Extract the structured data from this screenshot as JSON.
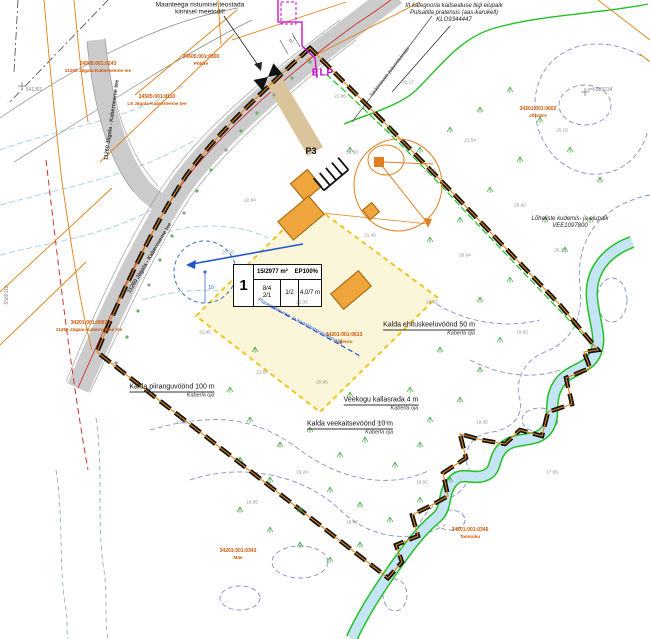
{
  "map": {
    "top_note": {
      "line1": "Maanteega ristumisel teostada",
      "line2": "kinnisel meetodil!"
    },
    "habitat_note": {
      "line1": "III kategooria kaitsealuse liigi elupaik",
      "line2": "Pulsatilla pratensis (aas-karukell)",
      "line3": "KLO9344447"
    },
    "salmon_note": {
      "line1": "Lõheliste kudemis- ja elupaik",
      "line2": "VEE1097800"
    },
    "elp_label": "ELP",
    "p3_label": "P3",
    "dim_label": "0,7",
    "well_radius_label": "10",
    "plot_table": {
      "pos": "1",
      "area": "15/2977 m²",
      "use": "EP100%",
      "c1a": "8/4",
      "c1b": "2/1",
      "c2": "1/2",
      "c3": "4,0/7 m"
    },
    "zone_labels": [
      {
        "tx": 172,
        "ty": 387,
        "sx": 158,
        "sy": 396,
        "title": "Kalda piiranguvöönd 100 m",
        "sub": "Kaberla oja"
      },
      {
        "tx": 429,
        "ty": 325,
        "sx": 445,
        "sy": 334,
        "title": "Kalda ehituskeeluvöönd 50 m",
        "sub": "Kaberla oja"
      },
      {
        "tx": 381,
        "ty": 400,
        "sx": 390,
        "sy": 410,
        "title": "Veekogu kallasrada 4 m",
        "sub": "Kaberla oja"
      },
      {
        "tx": 350,
        "ty": 424,
        "sx": 352,
        "sy": 434,
        "title": "Kalda veekaitsevöönd 10 m",
        "sub": "Kaberla oja"
      }
    ],
    "road_labels": [
      {
        "x": 112,
        "y": 120,
        "rot": -82,
        "text": "11260 Jägala - Kaberneeme tee"
      },
      {
        "x": 150,
        "y": 258,
        "rot": -59,
        "text": "11260 Jägala - Kaberneeme tee"
      }
    ],
    "pipe_label": {
      "x": 300,
      "y": 322,
      "rot": 28,
      "text": "Planeeritav vee- ja kanalisatsioonitorustik"
    },
    "ditch_label": {
      "x": 390,
      "y": 72,
      "rot": -52,
      "text": "Sademevee äravoolukraav"
    },
    "cadastral_labels": [
      {
        "x": 98,
        "y": 68,
        "code": "24505:001:0243",
        "name": "11260 Jägala-Kaberneeme tee"
      },
      {
        "x": 201,
        "y": 61,
        "code": "24505:001:0300",
        "name": "Põldre"
      },
      {
        "x": 157,
        "y": 101,
        "code": "24505:001:0110",
        "name": "L8 Jägala-Kaberneeme tee"
      },
      {
        "x": 89,
        "y": 327,
        "code": "34201:001:0062",
        "name": "11260 Jägala-Kaberneeme tee"
      },
      {
        "x": 538,
        "y": 113,
        "code": "34201:001:0602",
        "name": "Jõeääre"
      },
      {
        "x": 344,
        "y": 339,
        "code": "34201:001:0613",
        "name": "Lilleoru"
      },
      {
        "x": 238,
        "y": 555,
        "code": "34201:001:0343",
        "name": "Mäe"
      },
      {
        "x": 470,
        "y": 534,
        "code": "34201:001:0346",
        "name": "Tammiku"
      }
    ],
    "coord_labels": [
      {
        "x": 600,
        "y": 90,
        "rot": 0,
        "text": "x=6589234"
      },
      {
        "x": 34,
        "y": 90,
        "rot": 0,
        "text": "541361"
      },
      {
        "x": 7,
        "y": 295,
        "rot": -90,
        "text": "6589112"
      }
    ],
    "elevations": [
      {
        "x": 340,
        "y": 96,
        "v": "21.86"
      },
      {
        "x": 408,
        "y": 82,
        "v": "22.17"
      },
      {
        "x": 470,
        "y": 140,
        "v": "21.54"
      },
      {
        "x": 520,
        "y": 205,
        "v": "20.92"
      },
      {
        "x": 560,
        "y": 250,
        "v": "20.35"
      },
      {
        "x": 430,
        "y": 170,
        "v": "21.12"
      },
      {
        "x": 465,
        "y": 255,
        "v": "20.64"
      },
      {
        "x": 370,
        "y": 235,
        "v": "21.45"
      },
      {
        "x": 250,
        "y": 200,
        "v": "22.84"
      },
      {
        "x": 228,
        "y": 252,
        "v": "22.10"
      },
      {
        "x": 205,
        "y": 332,
        "v": "21.95"
      },
      {
        "x": 262,
        "y": 372,
        "v": "21.60"
      },
      {
        "x": 322,
        "y": 382,
        "v": "20.95"
      },
      {
        "x": 382,
        "y": 422,
        "v": "19.78"
      },
      {
        "x": 302,
        "y": 472,
        "v": "19.24"
      },
      {
        "x": 252,
        "y": 502,
        "v": "18.85"
      },
      {
        "x": 352,
        "y": 522,
        "v": "18.46"
      },
      {
        "x": 422,
        "y": 482,
        "v": "18.92"
      },
      {
        "x": 482,
        "y": 422,
        "v": "19.35"
      },
      {
        "x": 522,
        "y": 332,
        "v": "19.82"
      },
      {
        "x": 182,
        "y": 422,
        "v": "21.15"
      },
      {
        "x": 432,
        "y": 302,
        "v": "20.72"
      },
      {
        "x": 552,
        "y": 472,
        "v": "17.95"
      },
      {
        "x": 302,
        "y": 302,
        "v": "22.35"
      },
      {
        "x": 352,
        "y": 152,
        "v": "22.60"
      },
      {
        "x": 562,
        "y": 130,
        "v": "20.10"
      }
    ],
    "colors": {
      "boundary": "#111111",
      "cadastral_line": "#e08214",
      "cadastral_text": "#d35400",
      "road_fill": "#cbcbcb",
      "building_fill": "#f0a43c",
      "building_zone_fill": "#fbf5da",
      "building_zone_line": "#f0c420",
      "stream_fill": "#c5e4f5",
      "vegetation_green": "#22c022",
      "contour_blue": "#7584c2",
      "utility_magenta": "#cc00cc",
      "water_blue": "#2255cc",
      "road_axis_red": "#d03030",
      "driveway_tan": "#d9c49c"
    }
  }
}
